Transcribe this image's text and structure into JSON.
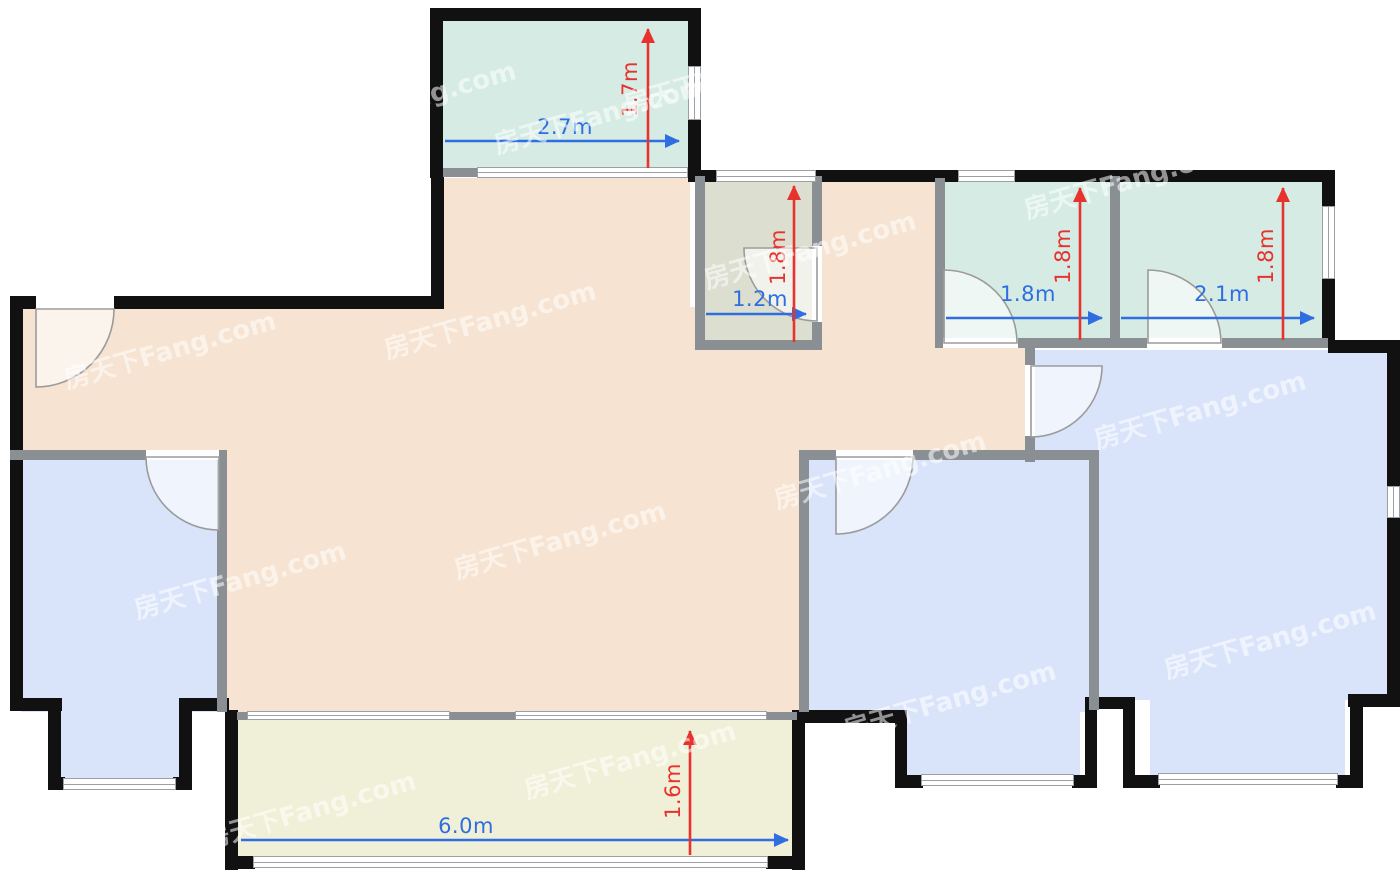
{
  "document": {
    "type": "residential floor plan"
  },
  "watermark": {
    "text": "房天下Fang.com"
  },
  "palette": {
    "outer_wall": "#111111",
    "interior_wall": "#8a8f94",
    "living": "#f6e3d1",
    "bedroom": "#d9e4fb",
    "green_room": "#d5ebe4",
    "bathroom": "#dcded0",
    "bottom_balcony": "#f0efd7",
    "dim_blue": "#2e6ee0",
    "dim_red": "#e8322d",
    "door_stroke": "#9b9b9b"
  },
  "dimensions": {
    "top_balcony": {
      "width": "2.7m",
      "height": "1.7m"
    },
    "bathroom": {
      "width": "1.2m",
      "height": "1.8m"
    },
    "room_small_1": {
      "width": "1.8m",
      "height": "1.8m"
    },
    "room_small_2": {
      "width": "2.1m",
      "height": "1.8m"
    },
    "bottom_balcony": {
      "width": "6.0m",
      "height": "1.6m"
    }
  }
}
